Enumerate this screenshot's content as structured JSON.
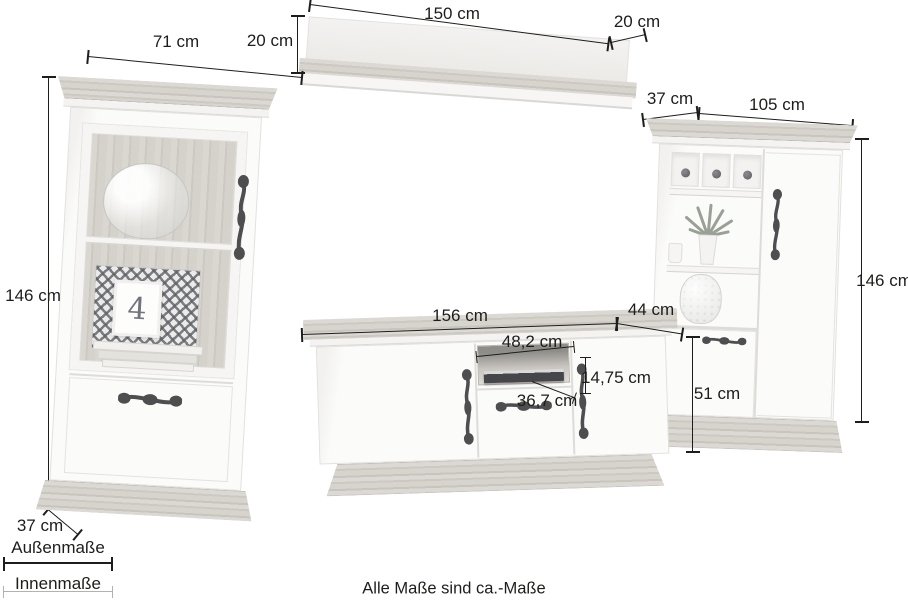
{
  "footer_note": "Alle Maße sind ca.-Maße",
  "legend": {
    "outer": "Außenmaße",
    "inner": "Innenmaße"
  },
  "decor": {
    "picture_frame_digit": "4"
  },
  "dimensions": {
    "left_cabinet": {
      "width": "71 cm",
      "height": "146 cm",
      "depth": "37 cm"
    },
    "wall_shelf": {
      "width": "150 cm",
      "height": "20 cm",
      "depth": "20 cm"
    },
    "lowboard": {
      "width": "156 cm",
      "depth": "44 cm",
      "height": "51 cm",
      "niche_width": "48,2 cm",
      "niche_height": "14,75 cm",
      "niche_depth": "36,7 cm"
    },
    "right_cabinet": {
      "depth": "37 cm",
      "width": "105 cm",
      "height": "146 cm"
    }
  },
  "colors": {
    "ink": "#1d1d1b",
    "inner_line": "#b4b2af",
    "wood_light": "#d8d5d0",
    "wood_dark": "#c9c6c0"
  }
}
